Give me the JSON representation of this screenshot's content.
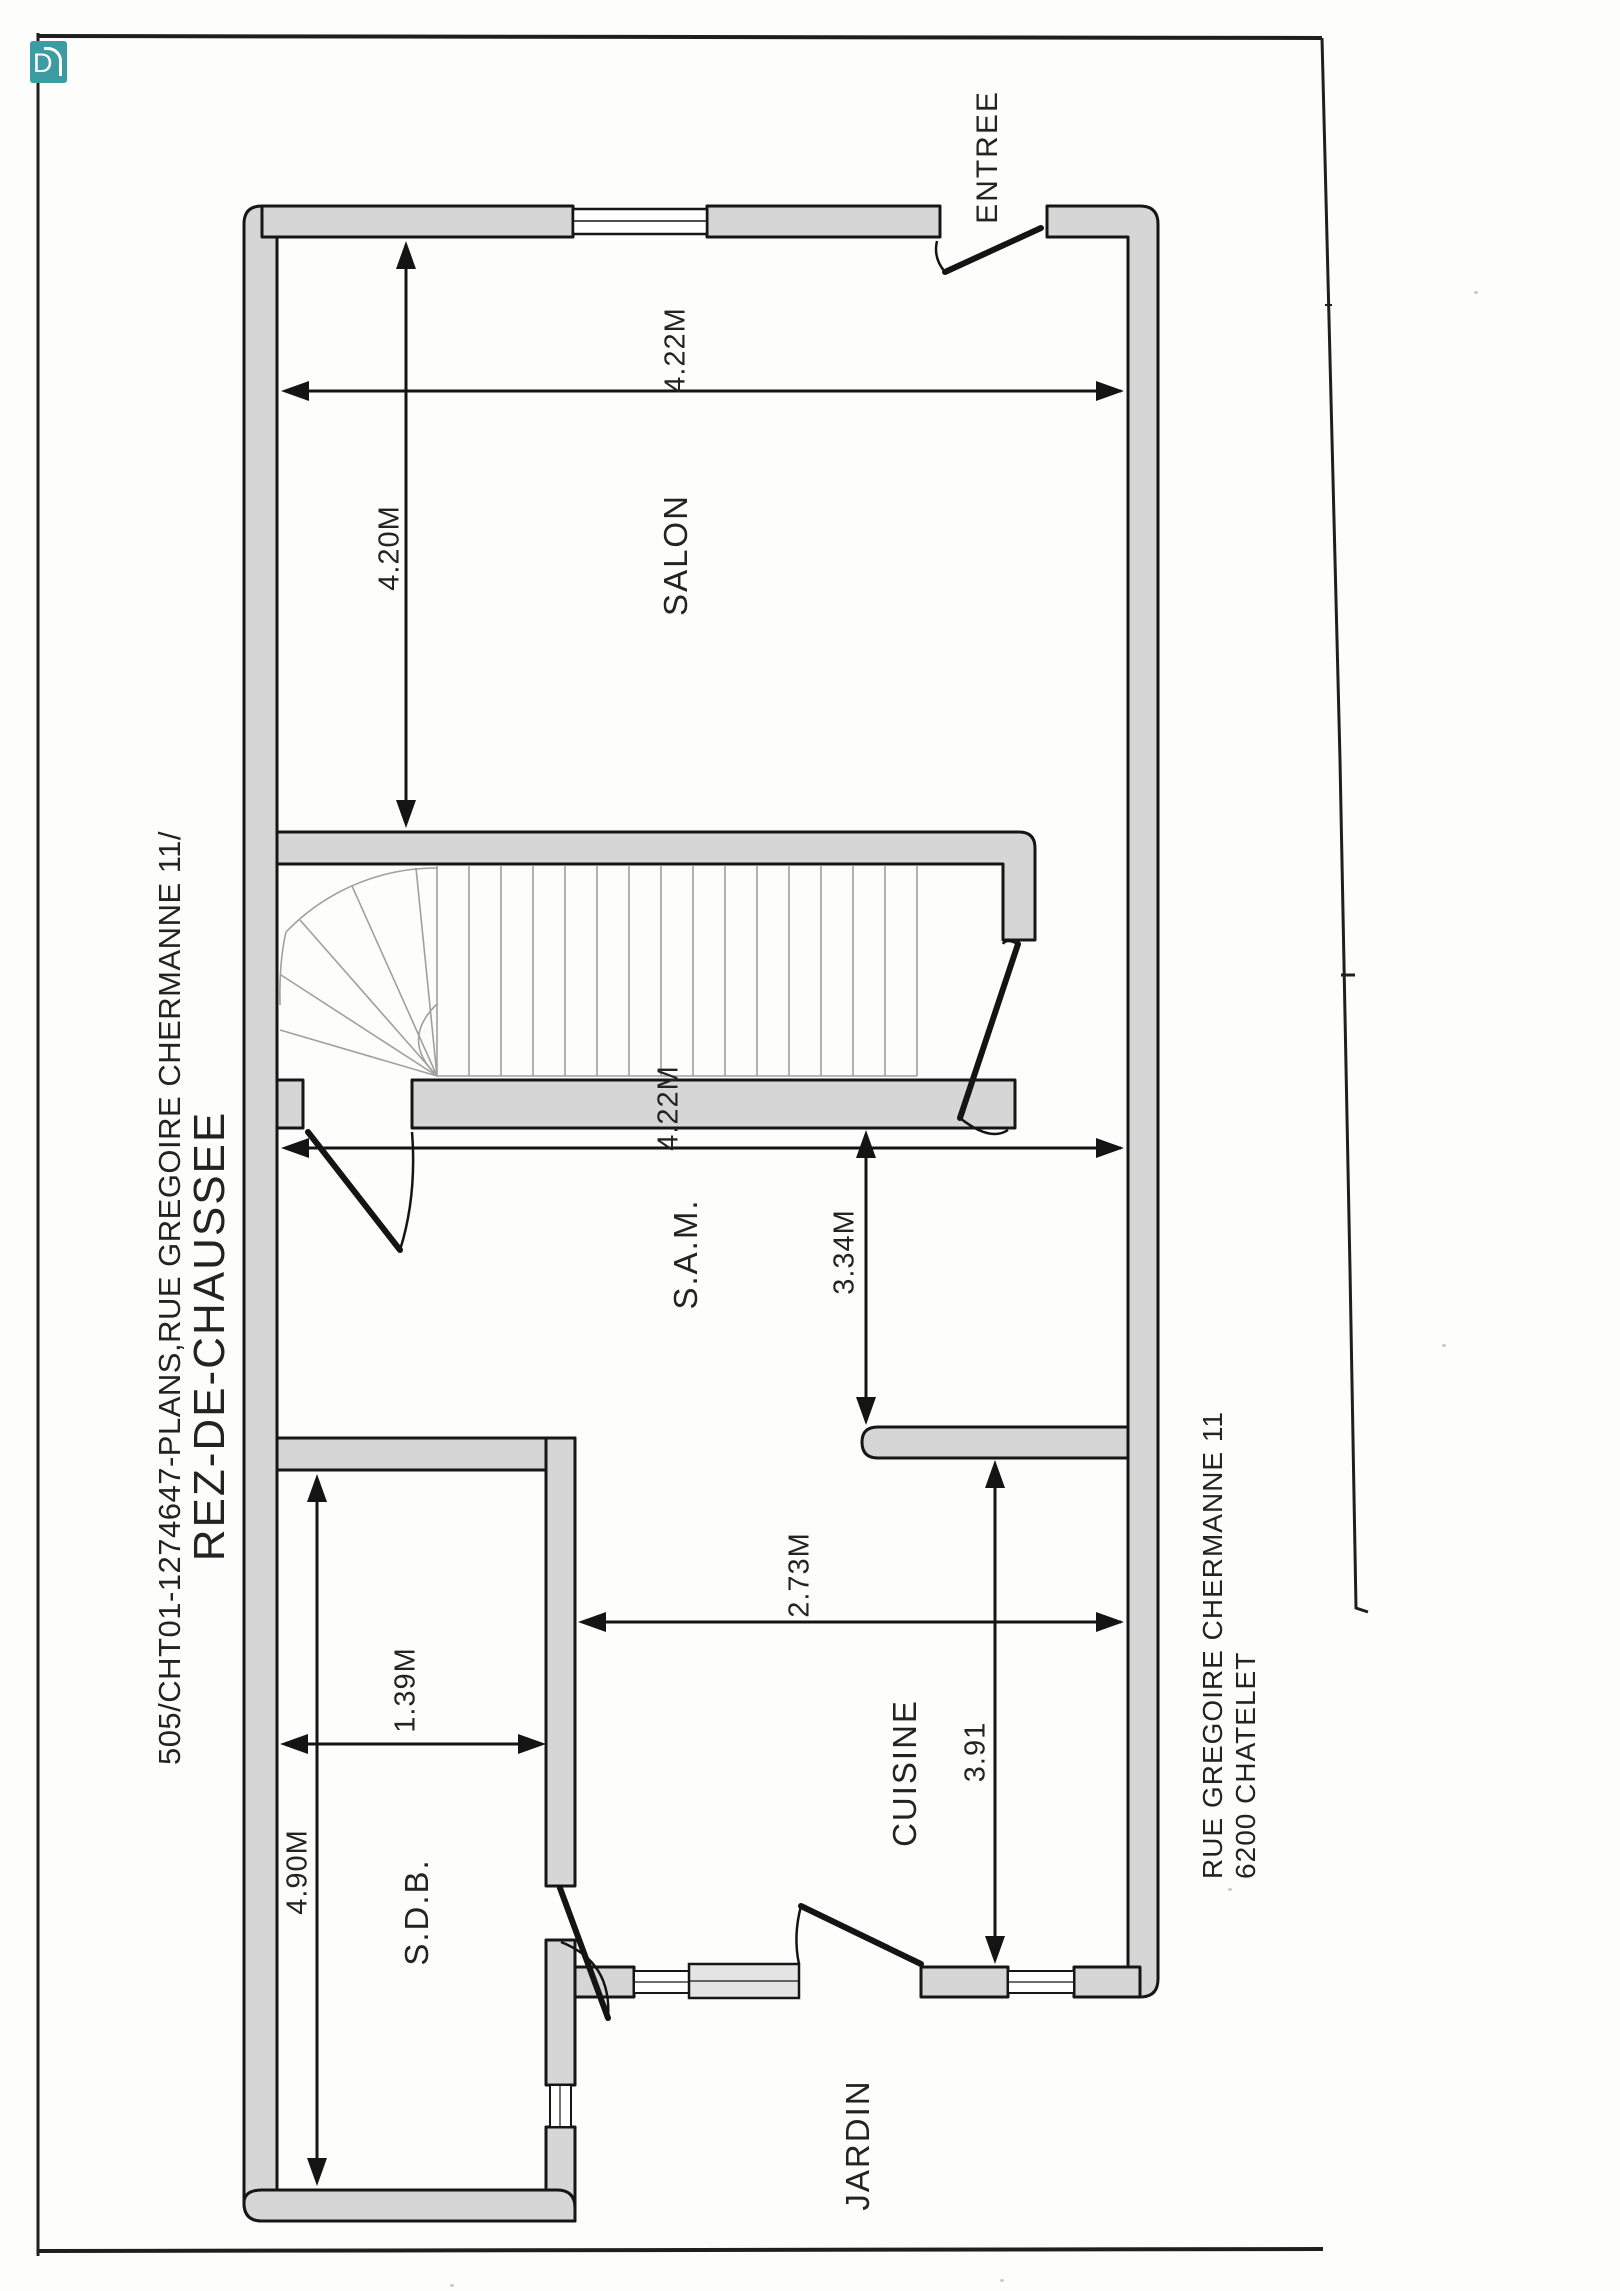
{
  "page": {
    "sheet_ref": "505/CHT01-1274647-PLANS,RUE GREGOIRE CHERMANNE 11/",
    "floor_title": "REZ-DE-CHAUSSEE"
  },
  "logo": {
    "text": "D",
    "color": "#3d9ba3"
  },
  "rooms": [
    {
      "label": "ENTREE"
    },
    {
      "label": "SALON"
    },
    {
      "label": "S.A.M."
    },
    {
      "label": "CUISINE"
    },
    {
      "label": "S.D.B."
    },
    {
      "label": "JARDIN"
    }
  ],
  "dimensions": [
    {
      "label": "4.22M",
      "value_m": 4.22
    },
    {
      "label": "4.20M",
      "value_m": 4.2
    },
    {
      "label": "4.22M",
      "value_m": 4.22
    },
    {
      "label": "3.34M",
      "value_m": 3.34
    },
    {
      "label": "2.73M",
      "value_m": 2.73
    },
    {
      "label": "3.91",
      "value_m": 3.91
    },
    {
      "label": "1.39M",
      "value_m": 1.39
    },
    {
      "label": "4.90M",
      "value_m": 4.9
    }
  ],
  "address": {
    "line1": "RUE GREGOIRE CHERMANNE 11",
    "line2": "6200 CHATELET"
  },
  "colors": {
    "wall_fill": "#d6d6d6",
    "line": "#161616",
    "accent_teal": "#3d9ba3",
    "stair_line": "#a0a0a0"
  }
}
